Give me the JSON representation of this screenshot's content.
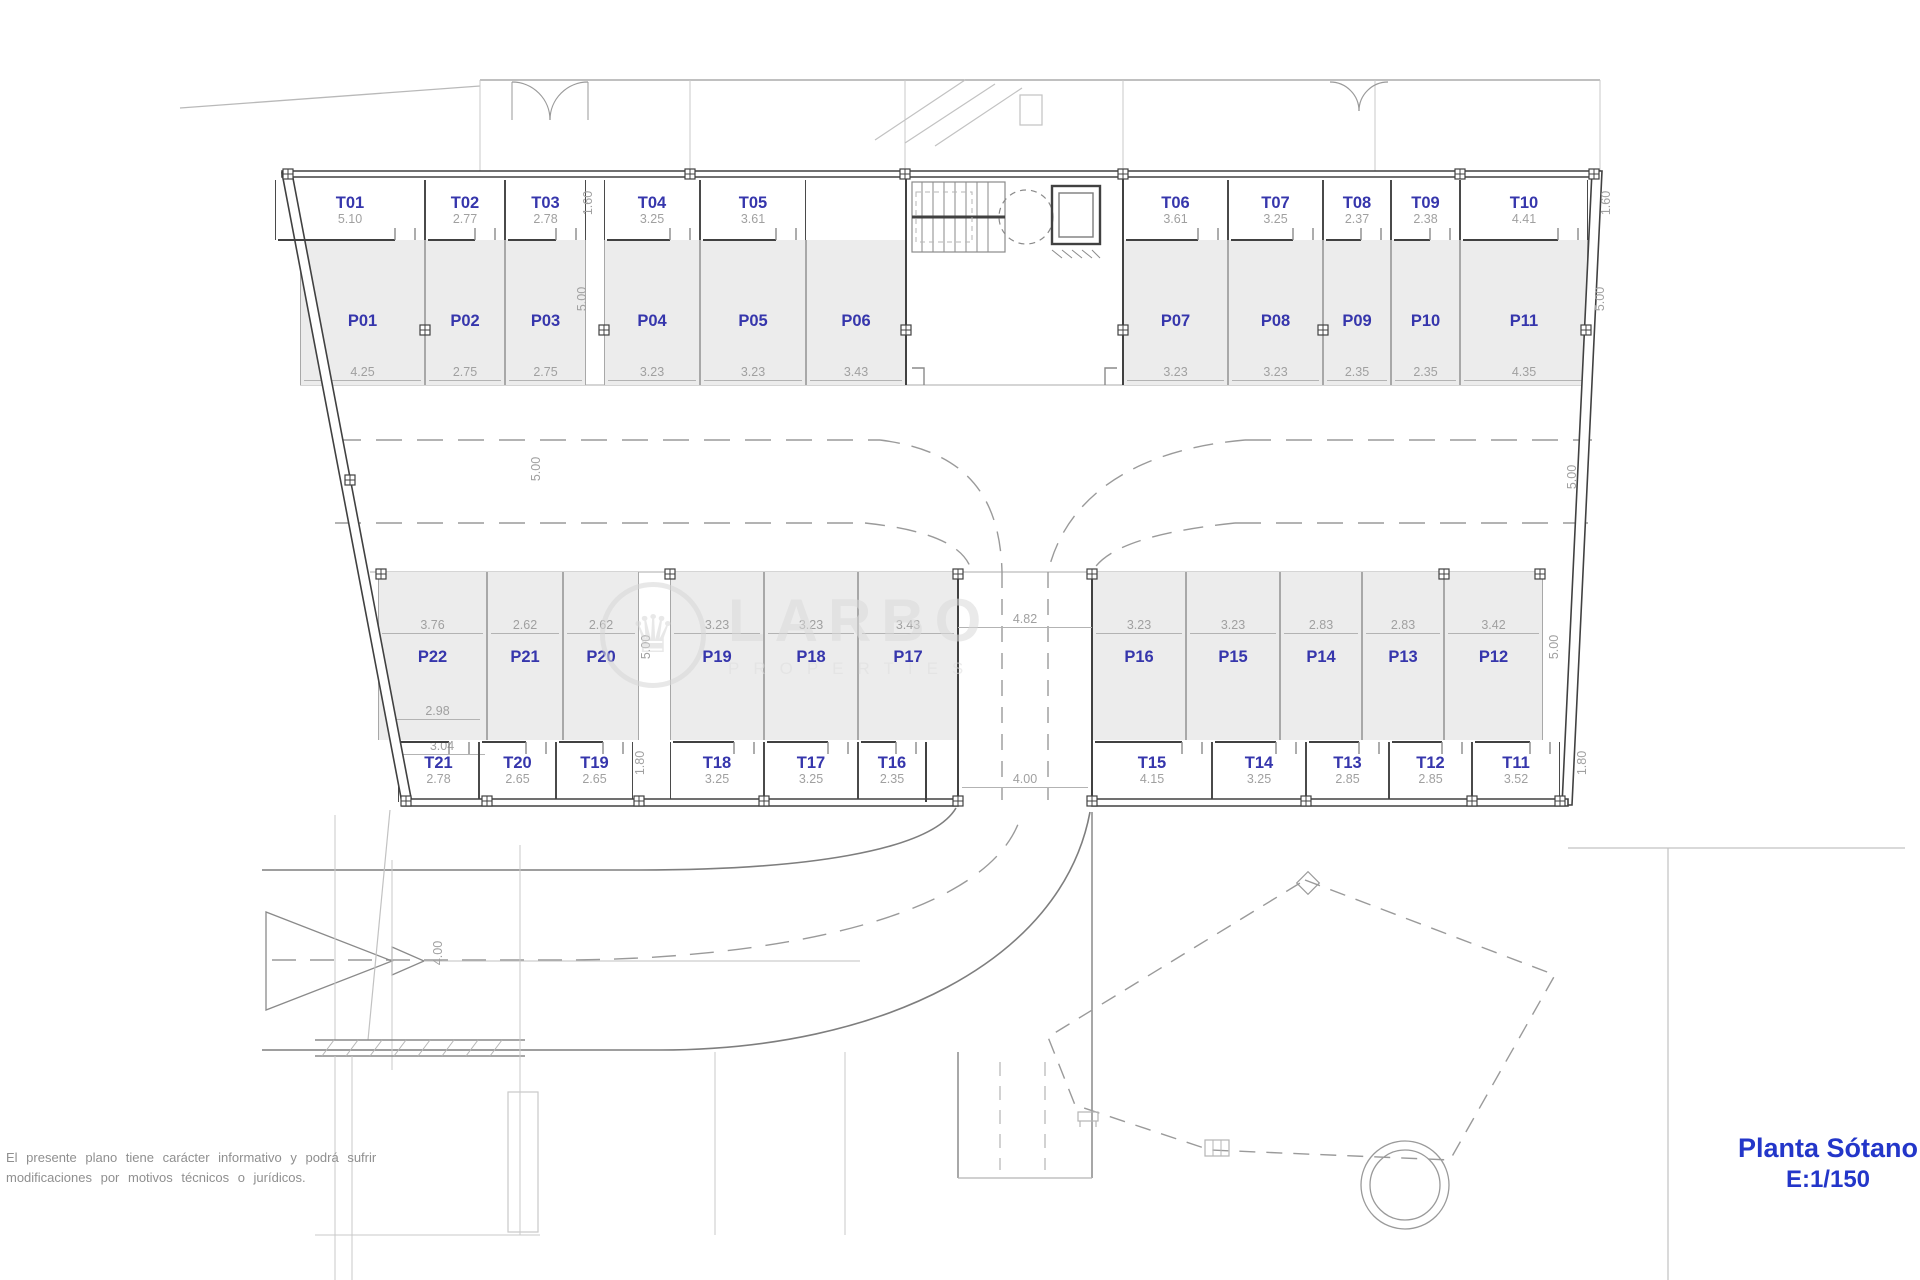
{
  "plan": {
    "title": "Planta Sótano",
    "scale": "E:1/150",
    "disclaimer_line1": "El presente plano tiene carácter informativo y podrá sufrir",
    "disclaimer_line2": "modificaciones por motivos técnicos o jurídicos.",
    "watermark_name": "LARBO",
    "watermark_sub": "PROPERTIES"
  },
  "colors": {
    "label_blue": "#3636ac",
    "title_blue": "#2336c9",
    "dim_gray": "#a0a0a0",
    "stall_fill": "#ececec",
    "wall_dark": "#414141"
  },
  "top_storage": [
    {
      "id": "T01",
      "width": "5.10"
    },
    {
      "id": "T02",
      "width": "2.77"
    },
    {
      "id": "T03",
      "width": "2.78"
    },
    {
      "id": "T04",
      "width": "3.25"
    },
    {
      "id": "T05",
      "width": "3.61"
    },
    {
      "id": "T06",
      "width": "3.61"
    },
    {
      "id": "T07",
      "width": "3.25"
    },
    {
      "id": "T08",
      "width": "2.37"
    },
    {
      "id": "T09",
      "width": "2.38"
    },
    {
      "id": "T10",
      "width": "4.41"
    }
  ],
  "top_parking": [
    {
      "id": "P01",
      "width": "4.25"
    },
    {
      "id": "P02",
      "width": "2.75"
    },
    {
      "id": "P03",
      "width": "2.75"
    },
    {
      "id": "P04",
      "width": "3.23"
    },
    {
      "id": "P05",
      "width": "3.23"
    },
    {
      "id": "P06",
      "width": "3.43"
    },
    {
      "id": "P07",
      "width": "3.23"
    },
    {
      "id": "P08",
      "width": "3.23"
    },
    {
      "id": "P09",
      "width": "2.35"
    },
    {
      "id": "P10",
      "width": "2.35"
    },
    {
      "id": "P11",
      "width": "4.35"
    }
  ],
  "bottom_parking": [
    {
      "id": "P22",
      "width": "3.76",
      "inner_width": "2.98"
    },
    {
      "id": "P21",
      "width": "2.62"
    },
    {
      "id": "P20",
      "width": "2.62"
    },
    {
      "id": "P19",
      "width": "3.23"
    },
    {
      "id": "P18",
      "width": "3.23"
    },
    {
      "id": "P17",
      "width": "3.43"
    },
    {
      "id": "P16",
      "width": "3.23"
    },
    {
      "id": "P15",
      "width": "3.23"
    },
    {
      "id": "P14",
      "width": "2.83"
    },
    {
      "id": "P13",
      "width": "2.83"
    },
    {
      "id": "P12",
      "width": "3.42"
    }
  ],
  "bottom_storage": [
    {
      "id": "T21",
      "width": "2.78",
      "outer_width": "3.04"
    },
    {
      "id": "T20",
      "width": "2.65"
    },
    {
      "id": "T19",
      "width": "2.65"
    },
    {
      "id": "T18",
      "width": "3.25"
    },
    {
      "id": "T17",
      "width": "3.25"
    },
    {
      "id": "T16",
      "width": "2.35"
    },
    {
      "id": "T15",
      "width": "4.15"
    },
    {
      "id": "T14",
      "width": "3.25"
    },
    {
      "id": "T13",
      "width": "2.85"
    },
    {
      "id": "T12",
      "width": "2.85"
    },
    {
      "id": "T11",
      "width": "3.52"
    }
  ],
  "dims": {
    "top_storage_depth": "1.60",
    "parking_depth": "5.00",
    "aisle_width": "5.00",
    "bottom_storage_depth": "1.80",
    "ramp_opening": "4.82",
    "ramp_width": "4.00",
    "road_width": "4.00"
  }
}
